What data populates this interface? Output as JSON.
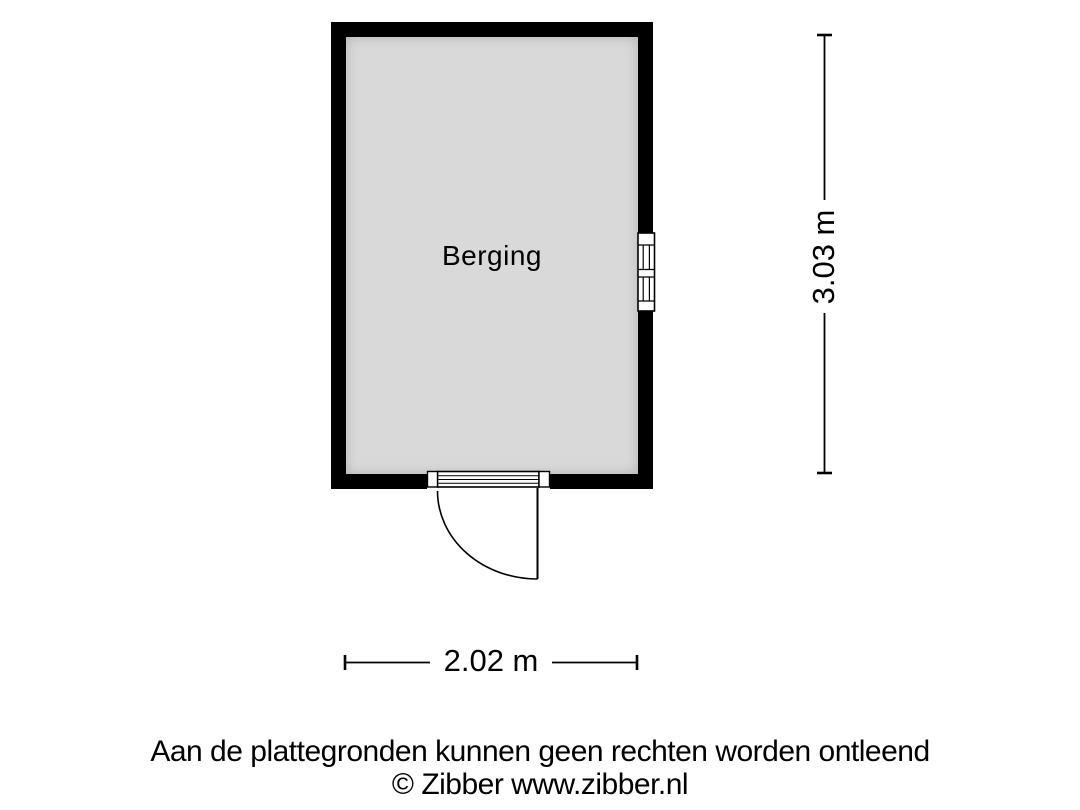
{
  "floorplan": {
    "room": {
      "label": "Berging"
    },
    "dimensions": {
      "height": "3.03 m",
      "width": "2.02 m"
    }
  },
  "footer": {
    "disclaimer": "Aan de plattegronden kunnen geen rechten worden ontleend",
    "copyright": "© Zibber www.zibber.nl"
  },
  "colors": {
    "wall": "#000000",
    "floor": "#d9d9d9",
    "line": "#000000",
    "text": "#000000",
    "background": "#ffffff"
  }
}
